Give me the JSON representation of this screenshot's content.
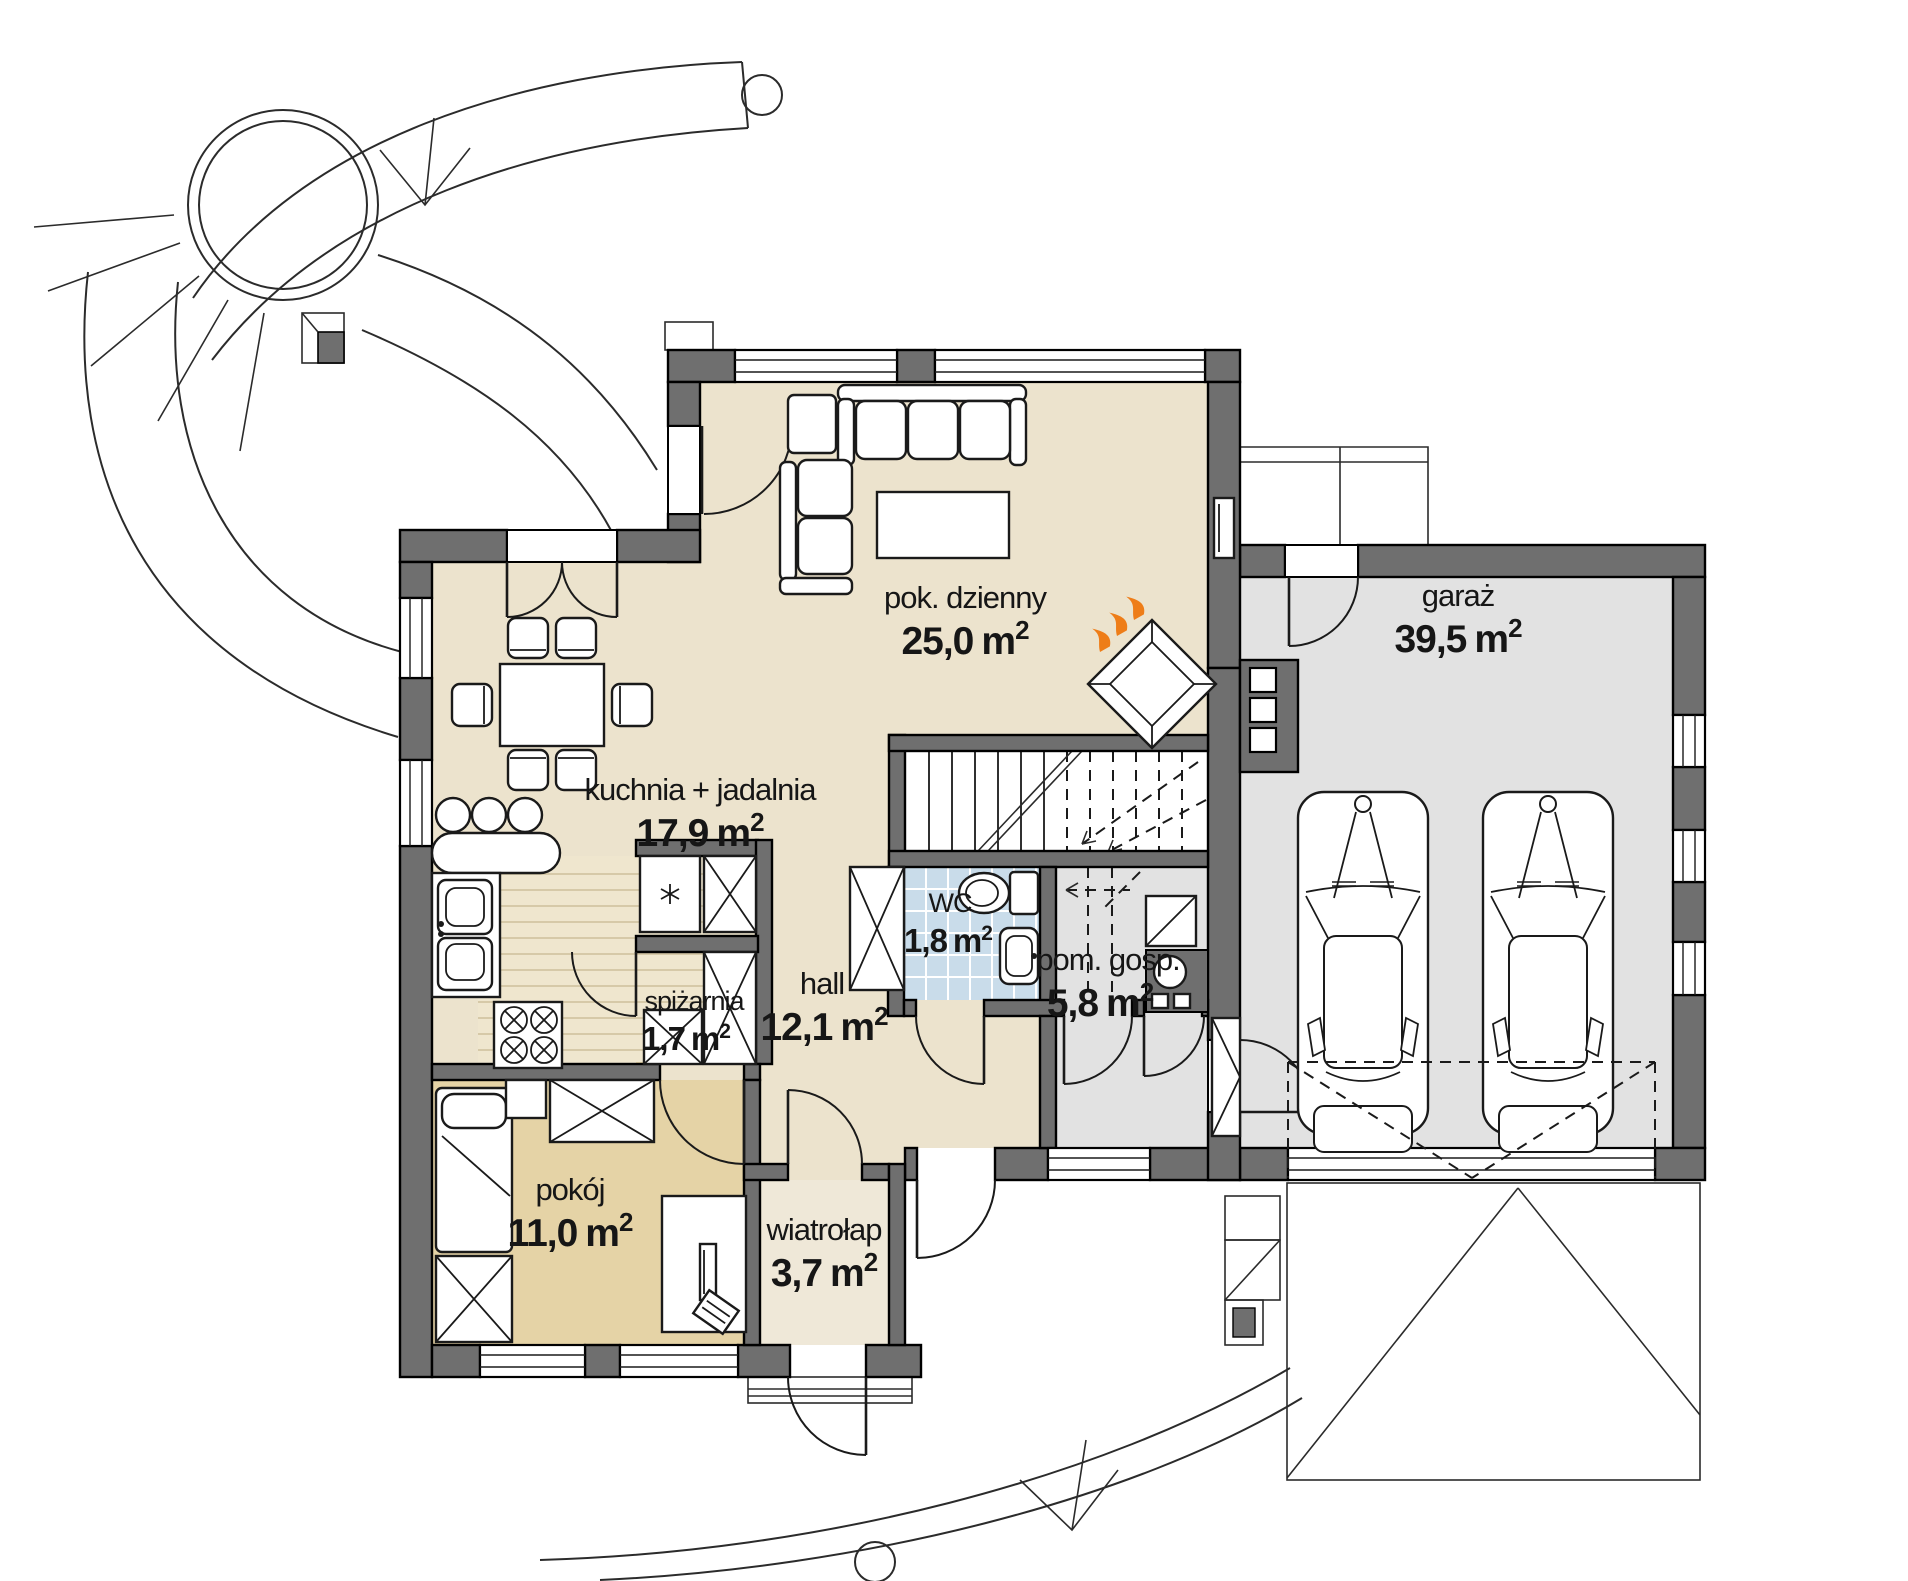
{
  "colors": {
    "wall": "#6F6F6F",
    "outline": "#1A1A1A",
    "floor_main": "#ECE3CD",
    "floor_tan": "#E5D3A6",
    "floor_gray": "#E2E2E2",
    "floor_tiles": "#C9DCEA",
    "floor_kitchen": "#EFE6CE",
    "floor_entry": "#EFE8D8",
    "flame": "#EE7D18",
    "background": "#FFFFFF"
  },
  "units": {
    "label": "m",
    "sup": "2"
  },
  "rooms": [
    {
      "name": "pok. dzienny",
      "area": "25,0"
    },
    {
      "name": "kuchnia + jadalnia",
      "area": "17,9"
    },
    {
      "name": "garaż",
      "area": "39,5"
    },
    {
      "name": "WC",
      "area": "1,8"
    },
    {
      "name": "pom. gosp.",
      "area": "5,8"
    },
    {
      "name": "spiżarnia",
      "area": "1,7"
    },
    {
      "name": "hall",
      "area": "12,1"
    },
    {
      "name": "pokój",
      "area": "11,0"
    },
    {
      "name": "wiatrołap",
      "area": "3,7"
    }
  ]
}
